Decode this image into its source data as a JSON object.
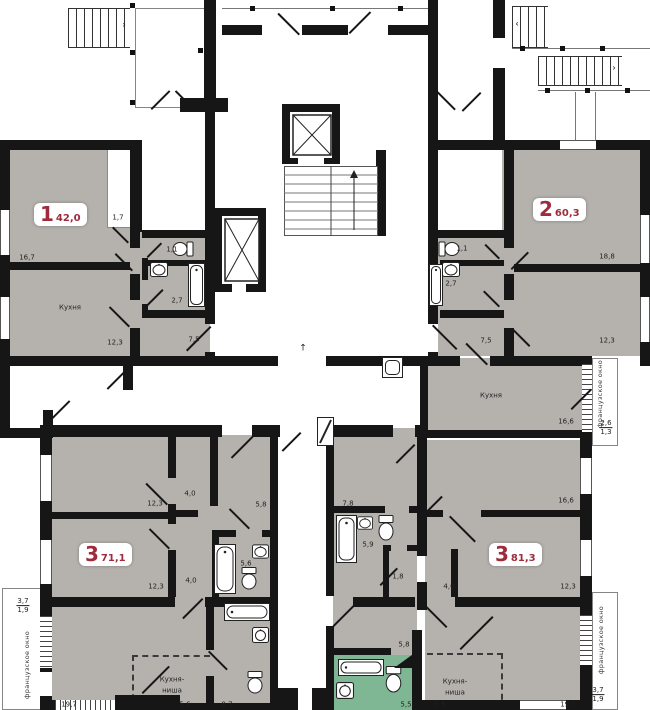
{
  "apartments": [
    {
      "number": "1",
      "area": "42,0"
    },
    {
      "number": "2",
      "area": "60,3"
    },
    {
      "number": "3",
      "area": "71,1"
    },
    {
      "number": "3",
      "area": "81,3"
    }
  ],
  "dims": [
    "1,7",
    "16,7",
    "Кухня",
    "12,3",
    "1,1",
    "2,7",
    "7,5",
    "1,1",
    "2,7",
    "7,5",
    "18,8",
    "12,3",
    "Кухня",
    "16,6",
    "12,3",
    "4,0",
    "5,8",
    "12,3",
    "4,0",
    "5,6",
    "Кухня-",
    "ниша",
    "19,7",
    "5,6",
    "8,7",
    "7,8",
    "5,9",
    "1,8",
    "5,8",
    "16,6",
    "12,3",
    "4,0",
    "Кухня-",
    "ниша",
    "5,5",
    "5,6",
    "19,7"
  ],
  "fractions": [
    {
      "top": "3,7",
      "bottom": "1,9"
    },
    {
      "top": "2,6",
      "bottom": "1,3"
    },
    {
      "top": "3,7",
      "bottom": "1,9"
    }
  ],
  "rotated_labels": [
    "французское окно",
    "французское окно",
    "французское окно"
  ],
  "glyphs": {
    "up_arrow": "↑",
    "stair_arrow_right": "›",
    "stair_arrow_left": "‹"
  },
  "colors": {
    "apartment_fill": "#b5b2ae",
    "wall": "#161616",
    "highlight_bathroom_fill": "#7fb794",
    "apartment_number": "#9e2c3c"
  }
}
